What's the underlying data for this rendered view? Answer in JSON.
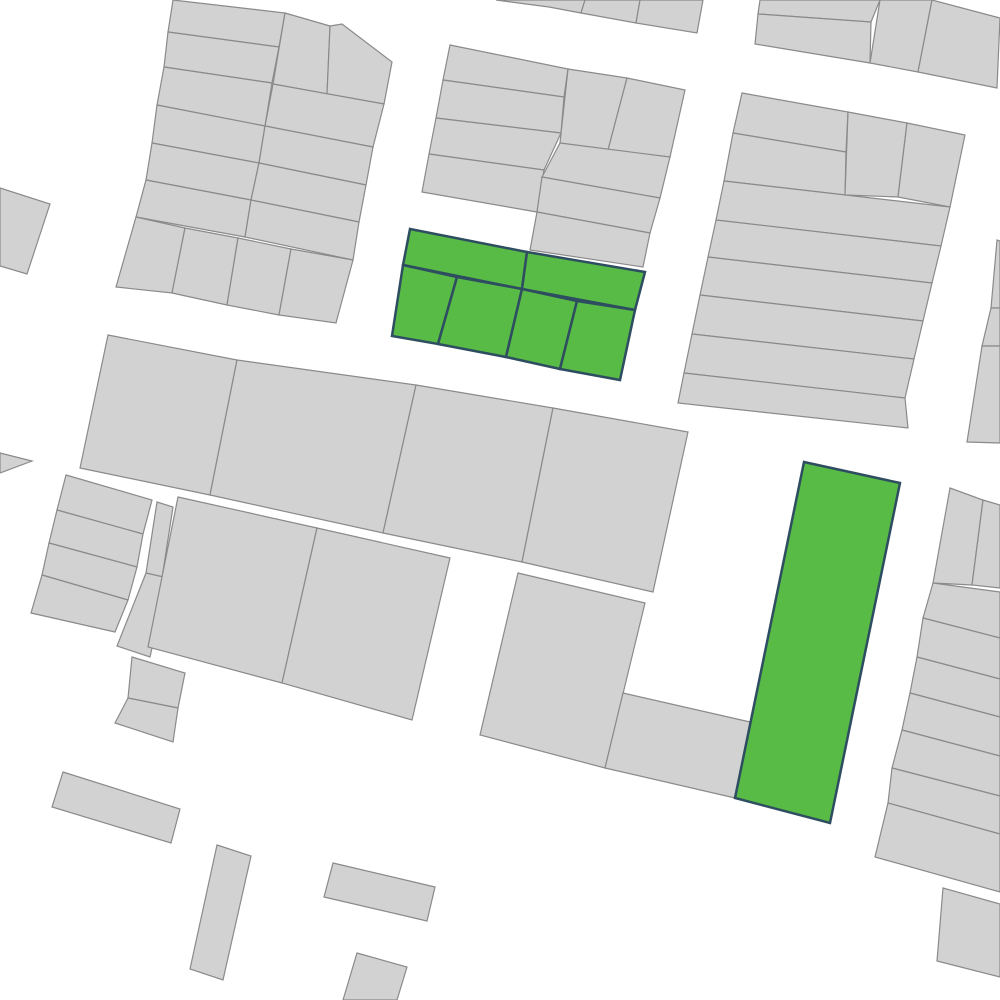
{
  "map": {
    "description": "cadastral-parcel-map",
    "canvas_width": 1000,
    "canvas_height": 1000,
    "colors": {
      "background": "#ffffff",
      "parcel_fill": "#d2d2d2",
      "parcel_stroke": "#8a8a8a",
      "highlight_fill": "#57bb46",
      "highlight_stroke": "#2e4d60"
    },
    "style": {
      "parcel_stroke_width": 1.2,
      "highlight_stroke_width": 2.5
    },
    "parcels": [
      {
        "id": "nw-row-0",
        "points": "173,0 285,13 279,47 168,32",
        "highlighted": false
      },
      {
        "id": "nw-row-1",
        "points": "168,32 279,47 272,83 164,67",
        "highlighted": false
      },
      {
        "id": "nw-row-2",
        "points": "164,67 272,83 265,126 157,105",
        "highlighted": false
      },
      {
        "id": "nw-row-3",
        "points": "157,105 265,126 259,163 152,143",
        "highlighted": false
      },
      {
        "id": "nw-row-4",
        "points": "152,143 259,163 251,200 146,180",
        "highlighted": false
      },
      {
        "id": "nw-row-5",
        "points": "146,180 251,200 245,237 136,217",
        "highlighted": false
      },
      {
        "id": "nw-tall-1",
        "points": "285,13 330,26 327,94 273,84",
        "highlighted": false
      },
      {
        "id": "nw-tall-2",
        "points": "330,26 342,24 392,62 384,104 327,94",
        "highlighted": false
      },
      {
        "id": "nw-right-row-1",
        "points": "273,84 384,104 373,147 265,126",
        "highlighted": false
      },
      {
        "id": "nw-right-row-2",
        "points": "265,126 373,147 366,185 259,163",
        "highlighted": false
      },
      {
        "id": "nw-right-row-3",
        "points": "259,163 366,185 359,222 251,200",
        "highlighted": false
      },
      {
        "id": "nw-right-row-4",
        "points": "251,200 359,222 353,260 245,237",
        "highlighted": false
      },
      {
        "id": "nw-lot-a",
        "points": "136,217 185,228 172,293 116,287",
        "highlighted": false
      },
      {
        "id": "nw-lot-b",
        "points": "185,228 238,238 227,305 172,293",
        "highlighted": false
      },
      {
        "id": "nw-lot-c",
        "points": "238,238 291,249 279,315 227,305",
        "highlighted": false
      },
      {
        "id": "nw-lot-d",
        "points": "291,249 353,260 336,323 279,315",
        "highlighted": false
      },
      {
        "id": "west-parcel",
        "points": "0,188 50,204 27,274 0,266",
        "highlighted": false
      },
      {
        "id": "west-edge-wedge",
        "points": "0,453 32,461 0,473",
        "highlighted": false
      },
      {
        "id": "north-strip-1",
        "points": "496,0 585,0 581,13 549,7",
        "highlighted": false
      },
      {
        "id": "north-strip-2",
        "points": "585,0 640,0 636,23 581,13",
        "highlighted": false
      },
      {
        "id": "north-strip-3",
        "points": "640,0 703,0 697,33 636,23",
        "highlighted": false
      },
      {
        "id": "ne-top-a1",
        "points": "760,0 880,0 871,22 758,14",
        "highlighted": false
      },
      {
        "id": "ne-top-a2",
        "points": "758,14 871,22 870,63 755,44",
        "highlighted": false
      },
      {
        "id": "ne-top-b",
        "points": "880,0 932,0 918,72 870,63",
        "highlighted": false
      },
      {
        "id": "ne-top-c",
        "points": "932,0 1000,18 997,88 918,72",
        "highlighted": false
      },
      {
        "id": "nc-row-1",
        "points": "450,45 568,69 564,97 443,80",
        "highlighted": false
      },
      {
        "id": "nc-row-2",
        "points": "443,80 564,97 561,133 436,118",
        "highlighted": false
      },
      {
        "id": "nc-row-3",
        "points": "436,118 561,133 544,170 429,154",
        "highlighted": false
      },
      {
        "id": "nc-row-4",
        "points": "429,154 544,170 537,212 422,192",
        "highlighted": false
      },
      {
        "id": "nc-tall-left",
        "points": "568,69 627,78 608,150 560,143",
        "highlighted": false
      },
      {
        "id": "nc-tall-right",
        "points": "627,78 685,90 670,157 608,150",
        "highlighted": false
      },
      {
        "id": "nc-row-x",
        "points": "560,143 670,157 660,198 542,177",
        "highlighted": false
      },
      {
        "id": "nc-row-y",
        "points": "542,177 660,198 650,233 537,212",
        "highlighted": false
      },
      {
        "id": "nc-row-z",
        "points": "537,212 650,233 643,267 530,250",
        "highlighted": false
      },
      {
        "id": "mid-parcel-1",
        "points": "108,335 237,360 210,495 80,468",
        "highlighted": false
      },
      {
        "id": "mid-parcel-2",
        "points": "237,360 416,385 383,533 210,495",
        "highlighted": false
      },
      {
        "id": "mid-parcel-3",
        "points": "416,385 553,408 522,562 383,533",
        "highlighted": false
      },
      {
        "id": "mid-parcel-4",
        "points": "553,408 688,432 653,592 522,562",
        "highlighted": false
      },
      {
        "id": "west-strip-1",
        "points": "66,475 152,500 143,534 57,510",
        "highlighted": false
      },
      {
        "id": "west-strip-2",
        "points": "57,510 143,534 137,567 49,543",
        "highlighted": false
      },
      {
        "id": "west-strip-3",
        "points": "49,543 137,567 128,600 42,575",
        "highlighted": false
      },
      {
        "id": "west-strip-4",
        "points": "42,575 128,600 115,632 31,613",
        "highlighted": false
      },
      {
        "id": "west-sliver-upper",
        "points": "157,502 173,507 162,578 146,573",
        "highlighted": false
      },
      {
        "id": "west-sliver-lower",
        "points": "146,573 168,578 150,657 117,646",
        "highlighted": false
      },
      {
        "id": "centerleft-parcel-1",
        "points": "178,497 317,528 282,683 148,647",
        "highlighted": false
      },
      {
        "id": "centerleft-parcel-2",
        "points": "317,528 450,558 412,720 282,683",
        "highlighted": false
      },
      {
        "id": "small-block-1",
        "points": "132,657 185,673 178,708 128,698",
        "highlighted": false
      },
      {
        "id": "small-block-2",
        "points": "128,698 178,708 173,742 115,723",
        "highlighted": false
      },
      {
        "id": "southcenter-a",
        "points": "518,573 645,603 605,768 480,735",
        "highlighted": false
      },
      {
        "id": "southcenter-b",
        "points": "623,693 750,722 735,798 605,768",
        "highlighted": false
      },
      {
        "id": "east-row-a",
        "points": "742,93 848,112 846,152 733,133",
        "highlighted": false
      },
      {
        "id": "east-row-b",
        "points": "733,133 846,152 845,195 724,181",
        "highlighted": false
      },
      {
        "id": "east-tall-a",
        "points": "848,112 907,123 898,197 845,195",
        "highlighted": false
      },
      {
        "id": "east-tall-b",
        "points": "907,123 965,135 950,207 898,197",
        "highlighted": false
      },
      {
        "id": "east-row-1",
        "points": "724,181 950,207 941,246 716,220",
        "highlighted": false
      },
      {
        "id": "east-row-2",
        "points": "716,220 941,246 932,283 708,257",
        "highlighted": false
      },
      {
        "id": "east-row-3",
        "points": "708,257 932,283 923,321 700,295",
        "highlighted": false
      },
      {
        "id": "east-row-4",
        "points": "700,295 923,321 914,359 692,334",
        "highlighted": false
      },
      {
        "id": "east-row-5",
        "points": "692,334 914,359 905,398 684,373",
        "highlighted": false
      },
      {
        "id": "east-row-6",
        "points": "684,373 905,398 908,428 678,403",
        "highlighted": false
      },
      {
        "id": "eastedge-s1",
        "points": "997,240 1000,241 1000,308 991,308",
        "highlighted": false
      },
      {
        "id": "eastedge-s2",
        "points": "991,308 1000,308 1000,346 982,346",
        "highlighted": false
      },
      {
        "id": "eastedge-s3",
        "points": "982,346 1000,346 1000,443 967,442",
        "highlighted": false
      },
      {
        "id": "se-col-left",
        "points": "950,488 983,500 972,585 933,583",
        "highlighted": false
      },
      {
        "id": "se-col-right",
        "points": "983,500 1000,505 1000,588 972,585",
        "highlighted": false
      },
      {
        "id": "se-strip-1",
        "points": "933,583 1000,592 1000,638 923,618",
        "highlighted": false
      },
      {
        "id": "se-strip-2",
        "points": "923,618 1000,638 1000,679 917,657",
        "highlighted": false
      },
      {
        "id": "se-strip-3",
        "points": "917,657 1000,679 1000,717 910,693",
        "highlighted": false
      },
      {
        "id": "se-strip-4",
        "points": "910,693 1000,717 1000,756 902,730",
        "highlighted": false
      },
      {
        "id": "se-strip-5",
        "points": "902,730 1000,756 1000,796 892,768",
        "highlighted": false
      },
      {
        "id": "se-strip-6",
        "points": "892,768 1000,796 1000,834 888,803",
        "highlighted": false
      },
      {
        "id": "se-strip-7",
        "points": "888,803 1000,834 1000,892 875,857",
        "highlighted": false
      },
      {
        "id": "se-corner",
        "points": "943,888 1000,904 1000,977 937,961",
        "highlighted": false
      },
      {
        "id": "sw-rect",
        "points": "63,772 180,809 171,843 52,807",
        "highlighted": false
      },
      {
        "id": "south-rect-vertical",
        "points": "217,845 251,856 223,980 190,969",
        "highlighted": false
      },
      {
        "id": "south-rect-2",
        "points": "333,863 435,887 427,921 324,897",
        "highlighted": false
      },
      {
        "id": "south-rect-3",
        "points": "357,953 407,967 397,1000 343,1000",
        "highlighted": false
      },
      {
        "id": "green-top-left",
        "points": "410,229 527,252 522,289 403,265",
        "highlighted": true
      },
      {
        "id": "green-top-right",
        "points": "527,252 645,272 635,310 522,289",
        "highlighted": true
      },
      {
        "id": "green-lot-1",
        "points": "403,265 457,277 438,344 392,336",
        "highlighted": true
      },
      {
        "id": "green-lot-2",
        "points": "457,277 522,289 506,357 438,344",
        "highlighted": true
      },
      {
        "id": "green-lot-3",
        "points": "522,289 577,301 560,369 506,357",
        "highlighted": true
      },
      {
        "id": "green-lot-4",
        "points": "577,301 635,310 620,380 560,369",
        "highlighted": true
      },
      {
        "id": "green-tall",
        "points": "804,462 900,483 830,823 735,798",
        "highlighted": true
      }
    ]
  }
}
